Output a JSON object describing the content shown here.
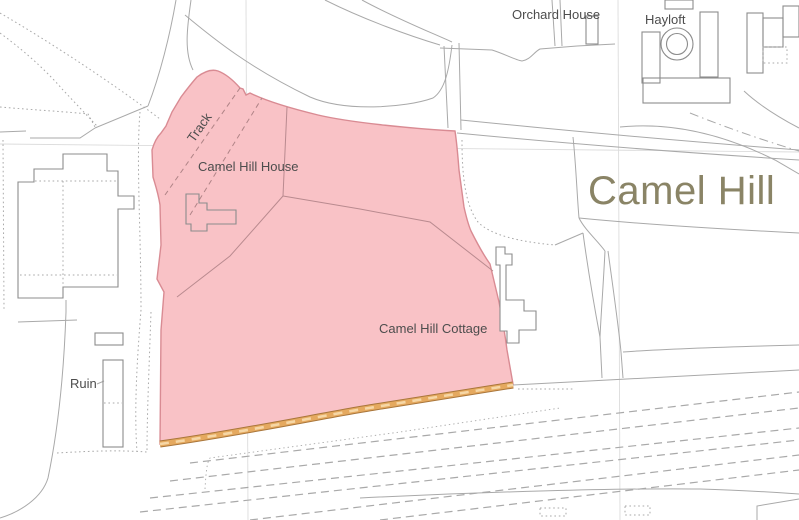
{
  "map": {
    "labels": {
      "orchard_house": "Orchard House",
      "hayloft": "Hayloft",
      "track": "Track",
      "camel_hill_house": "Camel Hill House",
      "place_name": "Camel Hill",
      "camel_hill_cottage": "Camel Hill Cottage",
      "ruin": "Ruin"
    },
    "colors": {
      "site-fill": "#f9c2c6",
      "site-outline": "#d98b93",
      "track-band-fill": "#e5a95f",
      "track-band-edge": "#a9763b",
      "map-line": "#a9a9a9",
      "grid-line": "#dcdcdc",
      "label-text": "#4d4d4d",
      "place-text": "#8a8466"
    }
  }
}
